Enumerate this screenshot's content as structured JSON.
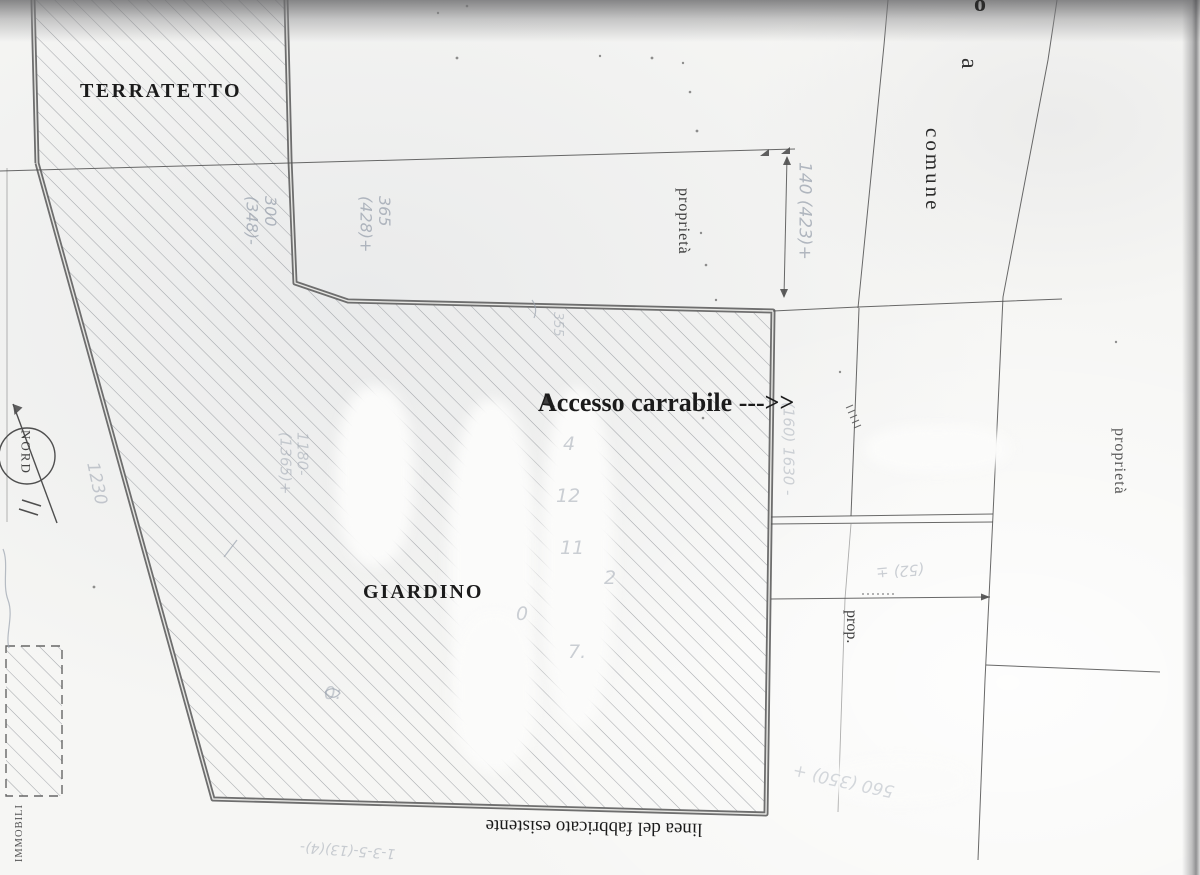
{
  "colors": {
    "paper": "#f6f6f4",
    "ink": "#1b1b1b",
    "line": "#4f4f4f",
    "border": "#6e6e6e",
    "pencil": "#9aa2ae"
  },
  "labels": {
    "terratetto": "TERRATETTO",
    "giardino": "GIARDINO",
    "accesso": "Accesso carrabile --->>",
    "proprieta_left": "proprietà",
    "a_marker": "a",
    "comune": "comune",
    "proprieta_right": "proprietà",
    "prop": "prop.",
    "linea_fabbricato": "linea del fabbricato esistente",
    "immobili": "IMMOBILI",
    "partial_letter": "o"
  },
  "compass": {
    "label": "NORD"
  },
  "annotations": {
    "dim_300": "300\n(348)-",
    "dim_365": "365\n(428)+",
    "dim_140": "140 (423)+",
    "dim_160": "(160) 1630 -",
    "dim_1230": "1230",
    "dim_1180": "1180-\n(1365)+",
    "dim_355": "355",
    "dim_52": "(52) ±",
    "dim_560": "560 (350) +",
    "dim_135": "1-3-5-(13)(4)-",
    "garden_digits": [
      "4",
      "12",
      "11",
      "2",
      "0",
      "7.",
      "0:"
    ]
  }
}
